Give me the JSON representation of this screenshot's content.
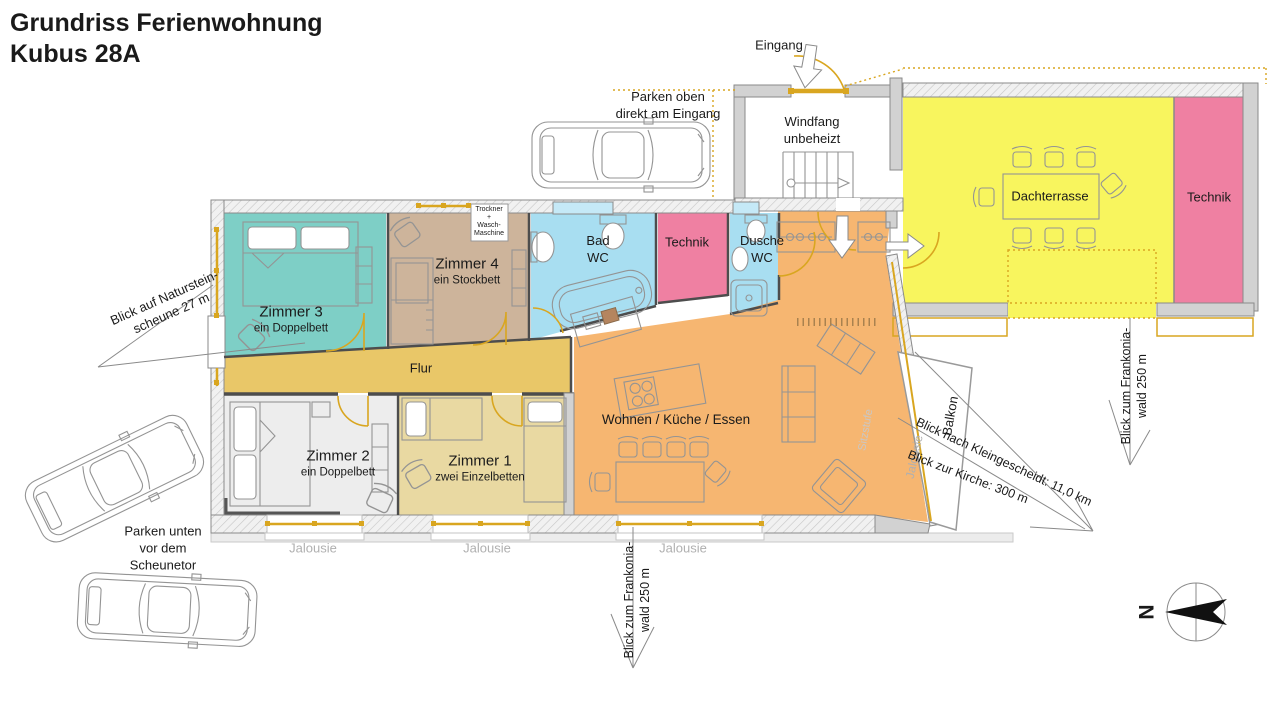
{
  "title": "Grundriss Ferienwohnung\nKubus 28A",
  "colors": {
    "zimmer3": "#7ecfc6",
    "zimmer4": "#cdb49b",
    "bad": "#a8def1",
    "technik": "#ef80a2",
    "dusche": "#a8def1",
    "flur": "#e9c768",
    "zimmer2": "#ededed",
    "zimmer1": "#e9d9a2",
    "wohnen": "#f6b671",
    "dachterrasse": "#f8f55e",
    "technik_dach": "#ef80a2",
    "balkon": "#ffffff",
    "gold_accent": "#d9a620"
  },
  "rooms": {
    "zimmer3": {
      "name": "Zimmer 3",
      "sub": "ein Doppelbett"
    },
    "zimmer4": {
      "name": "Zimmer 4",
      "sub": "ein Stockbett"
    },
    "bad": {
      "name": "Bad\nWC"
    },
    "technik": {
      "name": "Technik"
    },
    "dusche": {
      "name": "Dusche\nWC"
    },
    "flur": {
      "name": "Flur"
    },
    "zimmer2": {
      "name": "Zimmer 2",
      "sub": "ein Doppelbett"
    },
    "zimmer1": {
      "name": "Zimmer 1",
      "sub": "zwei Einzelbetten"
    },
    "wohnen": {
      "name": "Wohnen / Küche / Essen"
    },
    "windfang": {
      "name": "Windfang\nunbeheizt"
    },
    "dachterrasse": {
      "name": "Dachterrasse"
    },
    "technik_dach": {
      "name": "Technik"
    },
    "balkon": {
      "name": "Balkon"
    }
  },
  "annotations": {
    "eingang": "Eingang",
    "parken_oben": "Parken oben\ndirekt am Eingang",
    "parken_unten": "Parken unten\nvor dem\nScheunetor",
    "trockner": "Trockner\n+\nWasch-\nMaschine",
    "naturstein": "Blick auf Naturstein-\nscheune 27 m",
    "frankonia": "Blick zum Frankonia-\nwald 250 m",
    "kleingescheidt": "Blick nach Kleingescheidt: 11,0 km",
    "kirche": "Blick zur Kirche: 300 m",
    "sitzstufe": "Sitzstufe",
    "jalousie": "Jalousie",
    "north": "N"
  }
}
